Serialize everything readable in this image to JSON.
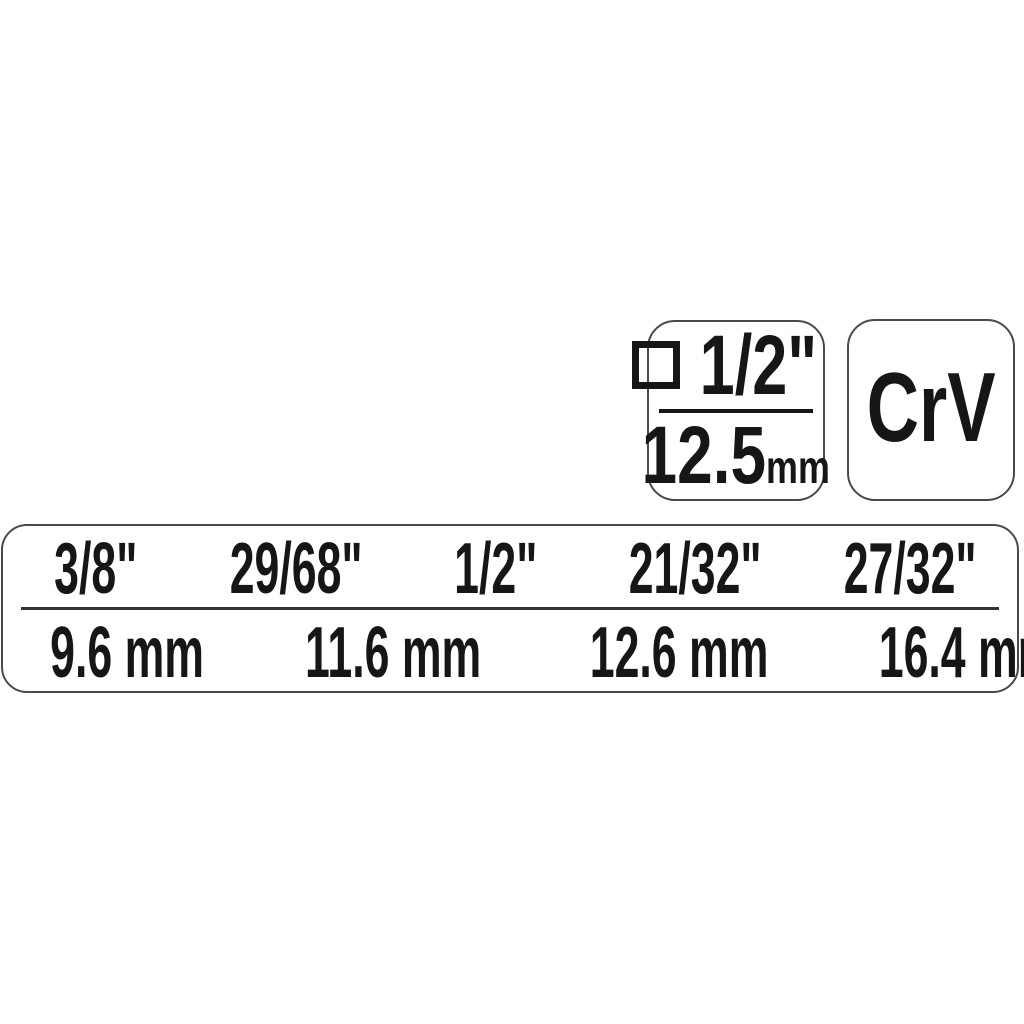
{
  "badges": {
    "drive": {
      "icon": "square-drive-icon",
      "size_inch": "1/2\"",
      "size_mm_value": "12.5",
      "size_mm_unit": "mm"
    },
    "material": {
      "label": "CrV"
    }
  },
  "size_table": {
    "columns": [
      {
        "inch": "3/8\"",
        "mm": "9.6 mm"
      },
      {
        "inch": "29/68\"",
        "mm": "11.6 mm"
      },
      {
        "inch": "1/2\"",
        "mm": "12.6 mm"
      },
      {
        "inch": "21/32\"",
        "mm": "16.4 mm"
      },
      {
        "inch": "27/32\"",
        "mm": "21 mm"
      }
    ]
  },
  "colors": {
    "text": "#161616",
    "border": "#4a4a4a",
    "background": "#ffffff"
  }
}
